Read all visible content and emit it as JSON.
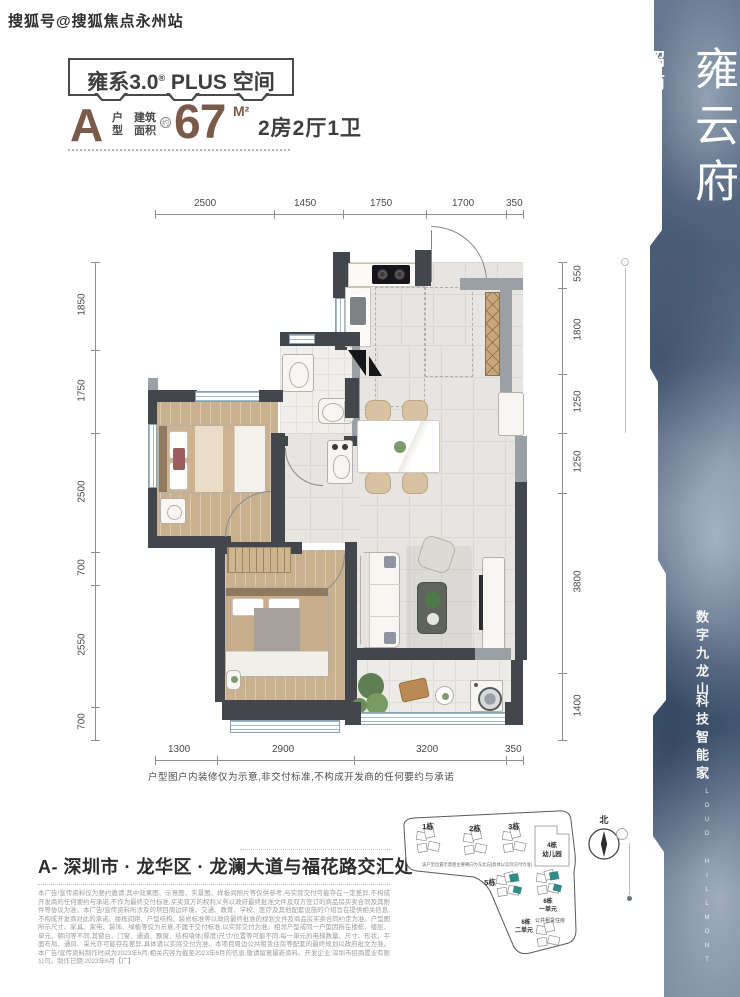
{
  "watermark": "搜狐号@搜狐焦点永州站",
  "header": {
    "box_prefix": "雍系3.0",
    "box_reg": "®",
    "box_plus": " PLUS ",
    "box_suffix": "空间",
    "unit_letter": "A",
    "unit_hu": "户",
    "unit_xing": "型",
    "area_l1": "建筑",
    "area_l2": "面积",
    "area_approx": "约",
    "area_value": "67",
    "area_unit": "M²",
    "rooms": "2房2厅1卫"
  },
  "banner": {
    "brand": "招商",
    "logo_glyph": "❖",
    "en1": "CLOUD",
    "en2": "HILLMONT",
    "name_cn": "雍云府",
    "slogan1": "数字九龙山",
    "slogan2": "科技智能家",
    "footer_en": "CLOUD HILLMONT"
  },
  "plan": {
    "dims_top": [
      "2500",
      "1450",
      "1750",
      "1700",
      "350"
    ],
    "dims_left": [
      "1850",
      "1750",
      "2500",
      "700",
      "2550",
      "700"
    ],
    "dims_right": [
      "550",
      "1800",
      "1250",
      "1250",
      "3800",
      "1400"
    ],
    "dims_bottom": [
      "1300",
      "2900",
      "3200",
      "350"
    ],
    "note": "户型图户内装修仅为示意,非交付标准,不构成开发商的任何要约与承诺"
  },
  "address": "A- 深圳市 · 龙华区 · 龙澜大道与福花路交汇处",
  "legal": "本广告/宣传资料仅为要约邀请,其中效果图、示意图、实景图、样板间照片等仅供参考,与实际交付可能存在一定差异,不构成开发商的任何要约与承诺,不作为最终交付标准,买卖双方的权利义务以政府最终批准文件及双方签订的商品房买卖合同及其附件等协议为准。本广告/宣传资料所涉及的项目周边环境、交通、教育、学校、医疗及其他配套设施的介绍旨在提供相关信息,不构成开发商对此的承诺。楼栋间距、户型结构、装修标准等以政府最终批准的规划文件及商品房买卖合同约定为准。户型图所示尺寸、家具、家电、装饰、绿植等仅为示意,不属于交付标准,以实际交付为准。相邻户型或同一户型因所在楼栋、楼层、单元、朝向等不同,其窗台、门窗、通道、飘窗、结构墙体(厚度)尺寸/位置等可能不同,每一单元的电梯数量、尺寸、形状、平面布局、通风、采光亦可能存在差异,具体请以实际交付为准。本项目周边公共租赁住房等配套的最终规划以政府批文为准。本广告/宣传资料制作时间为2023年6月,相关内容为截至2023年6月的信息,敬请留意最新资料。开发企业:深圳市招商置业有限公司。制作日期:2023年6月【广】",
  "sitemap": {
    "note": "该户型位置示意图主要朝向为东北向(具体以实际交付为准)",
    "b1": "1栋",
    "b2": "2栋",
    "b3": "3栋",
    "b4": "4栋",
    "b4_sub": "幼儿园",
    "b5": "5栋",
    "b6a": "6栋",
    "b6a_sub": "一单元",
    "b6b": "6栋",
    "b6b_sub": "二单元",
    "public": "公共租赁住房",
    "north": "北"
  },
  "colors": {
    "accent_brown": "#7a5b4b",
    "wall_dark": "#43464a",
    "banner_blue": "#54677e",
    "highlight_teal": "#2e8b85"
  }
}
